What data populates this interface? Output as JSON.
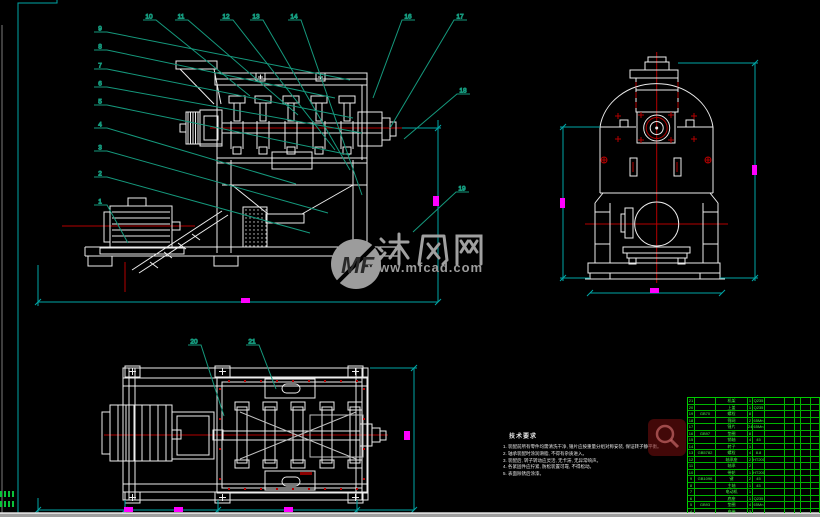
{
  "app": {
    "type": "CAD drawing view",
    "drawing": "hammer-mill crusher assembly, three orthographic views"
  },
  "colors": {
    "background": "#000000",
    "linework": "#ececec",
    "centerline_red": "#b40000",
    "dimension_cyan": "#00a6a6",
    "dimension_value_magenta": "#ff00ff",
    "balloon_green": "#1ecb43",
    "leader_teal": "#15997d",
    "table_green": "#00cc00",
    "watermark_gray": "#9c9c9c",
    "badge_red": "#781414"
  },
  "watermark": {
    "logo": "MF",
    "site_name": "沐风网",
    "url": "www.mfcad.com"
  },
  "notes": {
    "title": "技术要求",
    "items": [
      "1. 装配前所有零件均需清洗干净, 锤片应按重量分组对称安装, 保证转子静平衡。",
      "2. 轴承装配时涂润滑脂, 不得有杂质进入。",
      "3. 装配后, 转子转动应灵活, 无卡滞, 无异常响声。",
      "4. 各紧固件应拧紧, 防松装置可靠, 不得松动。",
      "5. 表面除锈后涂漆。"
    ]
  },
  "callouts": [
    {
      "n": "9",
      "lx": 100,
      "ly": 25,
      "ex": 350,
      "ey": 80
    },
    {
      "n": "8",
      "lx": 100,
      "ly": 43,
      "ex": 335,
      "ey": 98
    },
    {
      "n": "7",
      "lx": 100,
      "ly": 62,
      "ex": 353,
      "ey": 118
    },
    {
      "n": "6",
      "lx": 100,
      "ly": 80,
      "ex": 362,
      "ey": 133
    },
    {
      "n": "5",
      "lx": 100,
      "ly": 98,
      "ex": 350,
      "ey": 155
    },
    {
      "n": "4",
      "lx": 100,
      "ly": 121,
      "ex": 296,
      "ey": 184
    },
    {
      "n": "3",
      "lx": 100,
      "ly": 144,
      "ex": 328,
      "ey": 213
    },
    {
      "n": "2",
      "lx": 100,
      "ly": 170,
      "ex": 310,
      "ey": 233
    },
    {
      "n": "1",
      "lx": 100,
      "ly": 198,
      "ex": 128,
      "ey": 243
    },
    {
      "n": "10",
      "lx": 149,
      "ly": 13,
      "ex": 250,
      "ey": 96
    },
    {
      "n": "11",
      "lx": 181,
      "ly": 13,
      "ex": 298,
      "ey": 115
    },
    {
      "n": "12",
      "lx": 226,
      "ly": 13,
      "ex": 335,
      "ey": 150
    },
    {
      "n": "13",
      "lx": 256,
      "ly": 13,
      "ex": 350,
      "ey": 170
    },
    {
      "n": "14",
      "lx": 294,
      "ly": 13,
      "ex": 362,
      "ey": 195
    },
    {
      "n": "16",
      "lx": 408,
      "ly": 13,
      "ex": 373,
      "ey": 98
    },
    {
      "n": "17",
      "lx": 460,
      "ly": 13,
      "ex": 390,
      "ey": 128
    },
    {
      "n": "18",
      "lx": 463,
      "ly": 87,
      "ex": 404,
      "ey": 139
    },
    {
      "n": "19",
      "lx": 462,
      "ly": 185,
      "ex": 413,
      "ey": 232
    },
    {
      "n": "20",
      "lx": 194,
      "ly": 338,
      "ex": 224,
      "ey": 416
    },
    {
      "n": "21",
      "lx": 252,
      "ly": 338,
      "ex": 276,
      "ey": 389
    }
  ],
  "bom_table": {
    "col_widths": [
      7,
      21,
      32,
      5,
      12,
      20,
      10,
      6,
      10,
      9
    ],
    "rows": [
      [
        "21",
        "",
        "机架",
        "1",
        "Q235",
        "",
        "",
        "",
        "",
        ""
      ],
      [
        "20",
        "",
        "上盖",
        "1",
        "Q235",
        "",
        "",
        "",
        "",
        ""
      ],
      [
        "19",
        "GB70",
        "螺栓",
        "8",
        "",
        "",
        "",
        "",
        "",
        ""
      ],
      [
        "18",
        "",
        "筛网",
        "2",
        "65Mn",
        "",
        "",
        "",
        "",
        ""
      ],
      [
        "17",
        "",
        "锤片",
        "24",
        "65Mn",
        "",
        "",
        "",
        "",
        ""
      ],
      [
        "16",
        "GB97",
        "垫圈",
        "8",
        "",
        "",
        "",
        "",
        "",
        ""
      ],
      [
        "15",
        "",
        "销轴",
        "4",
        "45",
        "",
        "",
        "",
        "",
        ""
      ],
      [
        "14",
        "",
        "转子",
        "1",
        "",
        "",
        "",
        "",
        "",
        ""
      ],
      [
        "13",
        "GB5782",
        "螺栓",
        "4",
        "8.8",
        "",
        "",
        "",
        "",
        ""
      ],
      [
        "12",
        "",
        "轴承座",
        "2",
        "HT200",
        "",
        "",
        "",
        "",
        ""
      ],
      [
        "11",
        "",
        "轴承",
        "2",
        "",
        "",
        "",
        "",
        "",
        ""
      ],
      [
        "10",
        "",
        "带轮",
        "1",
        "HT200",
        "",
        "",
        "",
        "",
        ""
      ],
      [
        "9",
        "GB1096",
        "键",
        "2",
        "45",
        "",
        "",
        "",
        "",
        ""
      ],
      [
        "8",
        "",
        "主轴",
        "1",
        "45",
        "",
        "",
        "",
        "",
        ""
      ],
      [
        "7",
        "",
        "电动机",
        "1",
        "",
        "",
        "",
        "",
        "",
        ""
      ],
      [
        "6",
        "",
        "底座",
        "1",
        "Q235",
        "",
        "",
        "",
        "",
        ""
      ],
      [
        "5",
        "GB93",
        "垫圈",
        "4",
        "65Mn",
        "",
        "",
        "",
        "",
        ""
      ],
      [
        "4",
        "",
        "皮带",
        "3",
        "",
        "",
        "",
        "",
        "",
        ""
      ]
    ]
  }
}
